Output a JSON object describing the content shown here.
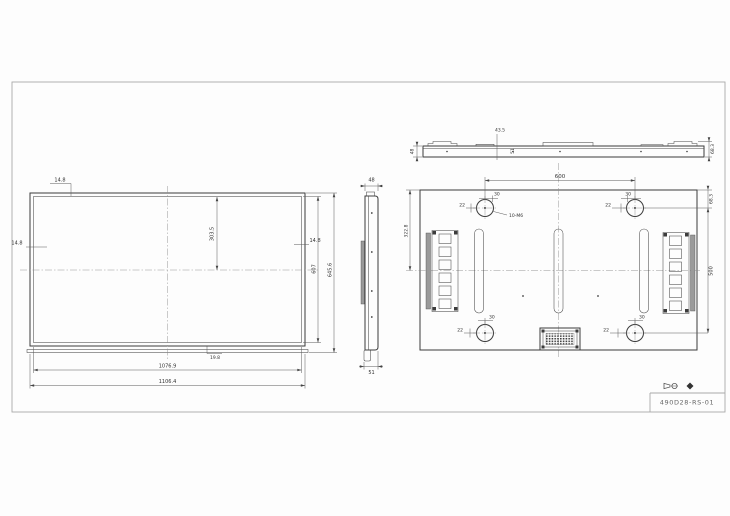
{
  "title_block": {
    "drawing_number": "490D28-RS-01"
  },
  "front": {
    "bezel_top": "14.8",
    "bezel_left": "14.8",
    "bezel_right": "14.8",
    "half_height": "303.5",
    "active_height": "607",
    "overall_height": "645.6",
    "bottom_gap": "19.8",
    "active_width": "1076.9",
    "overall_width": "1106.4"
  },
  "side": {
    "top_depth": "48",
    "bottom_depth": "51"
  },
  "top": {
    "left_depth": "48",
    "notch_offset": "43.5",
    "step": "51",
    "right_depth": "68.3"
  },
  "rear": {
    "vesa_h": "600",
    "vesa_v": "500",
    "edge_to_hole": "68.3",
    "edge_to_center": "322.8",
    "hole_offset": "22",
    "hole_boss": "30",
    "thread_note": "10-M6"
  }
}
